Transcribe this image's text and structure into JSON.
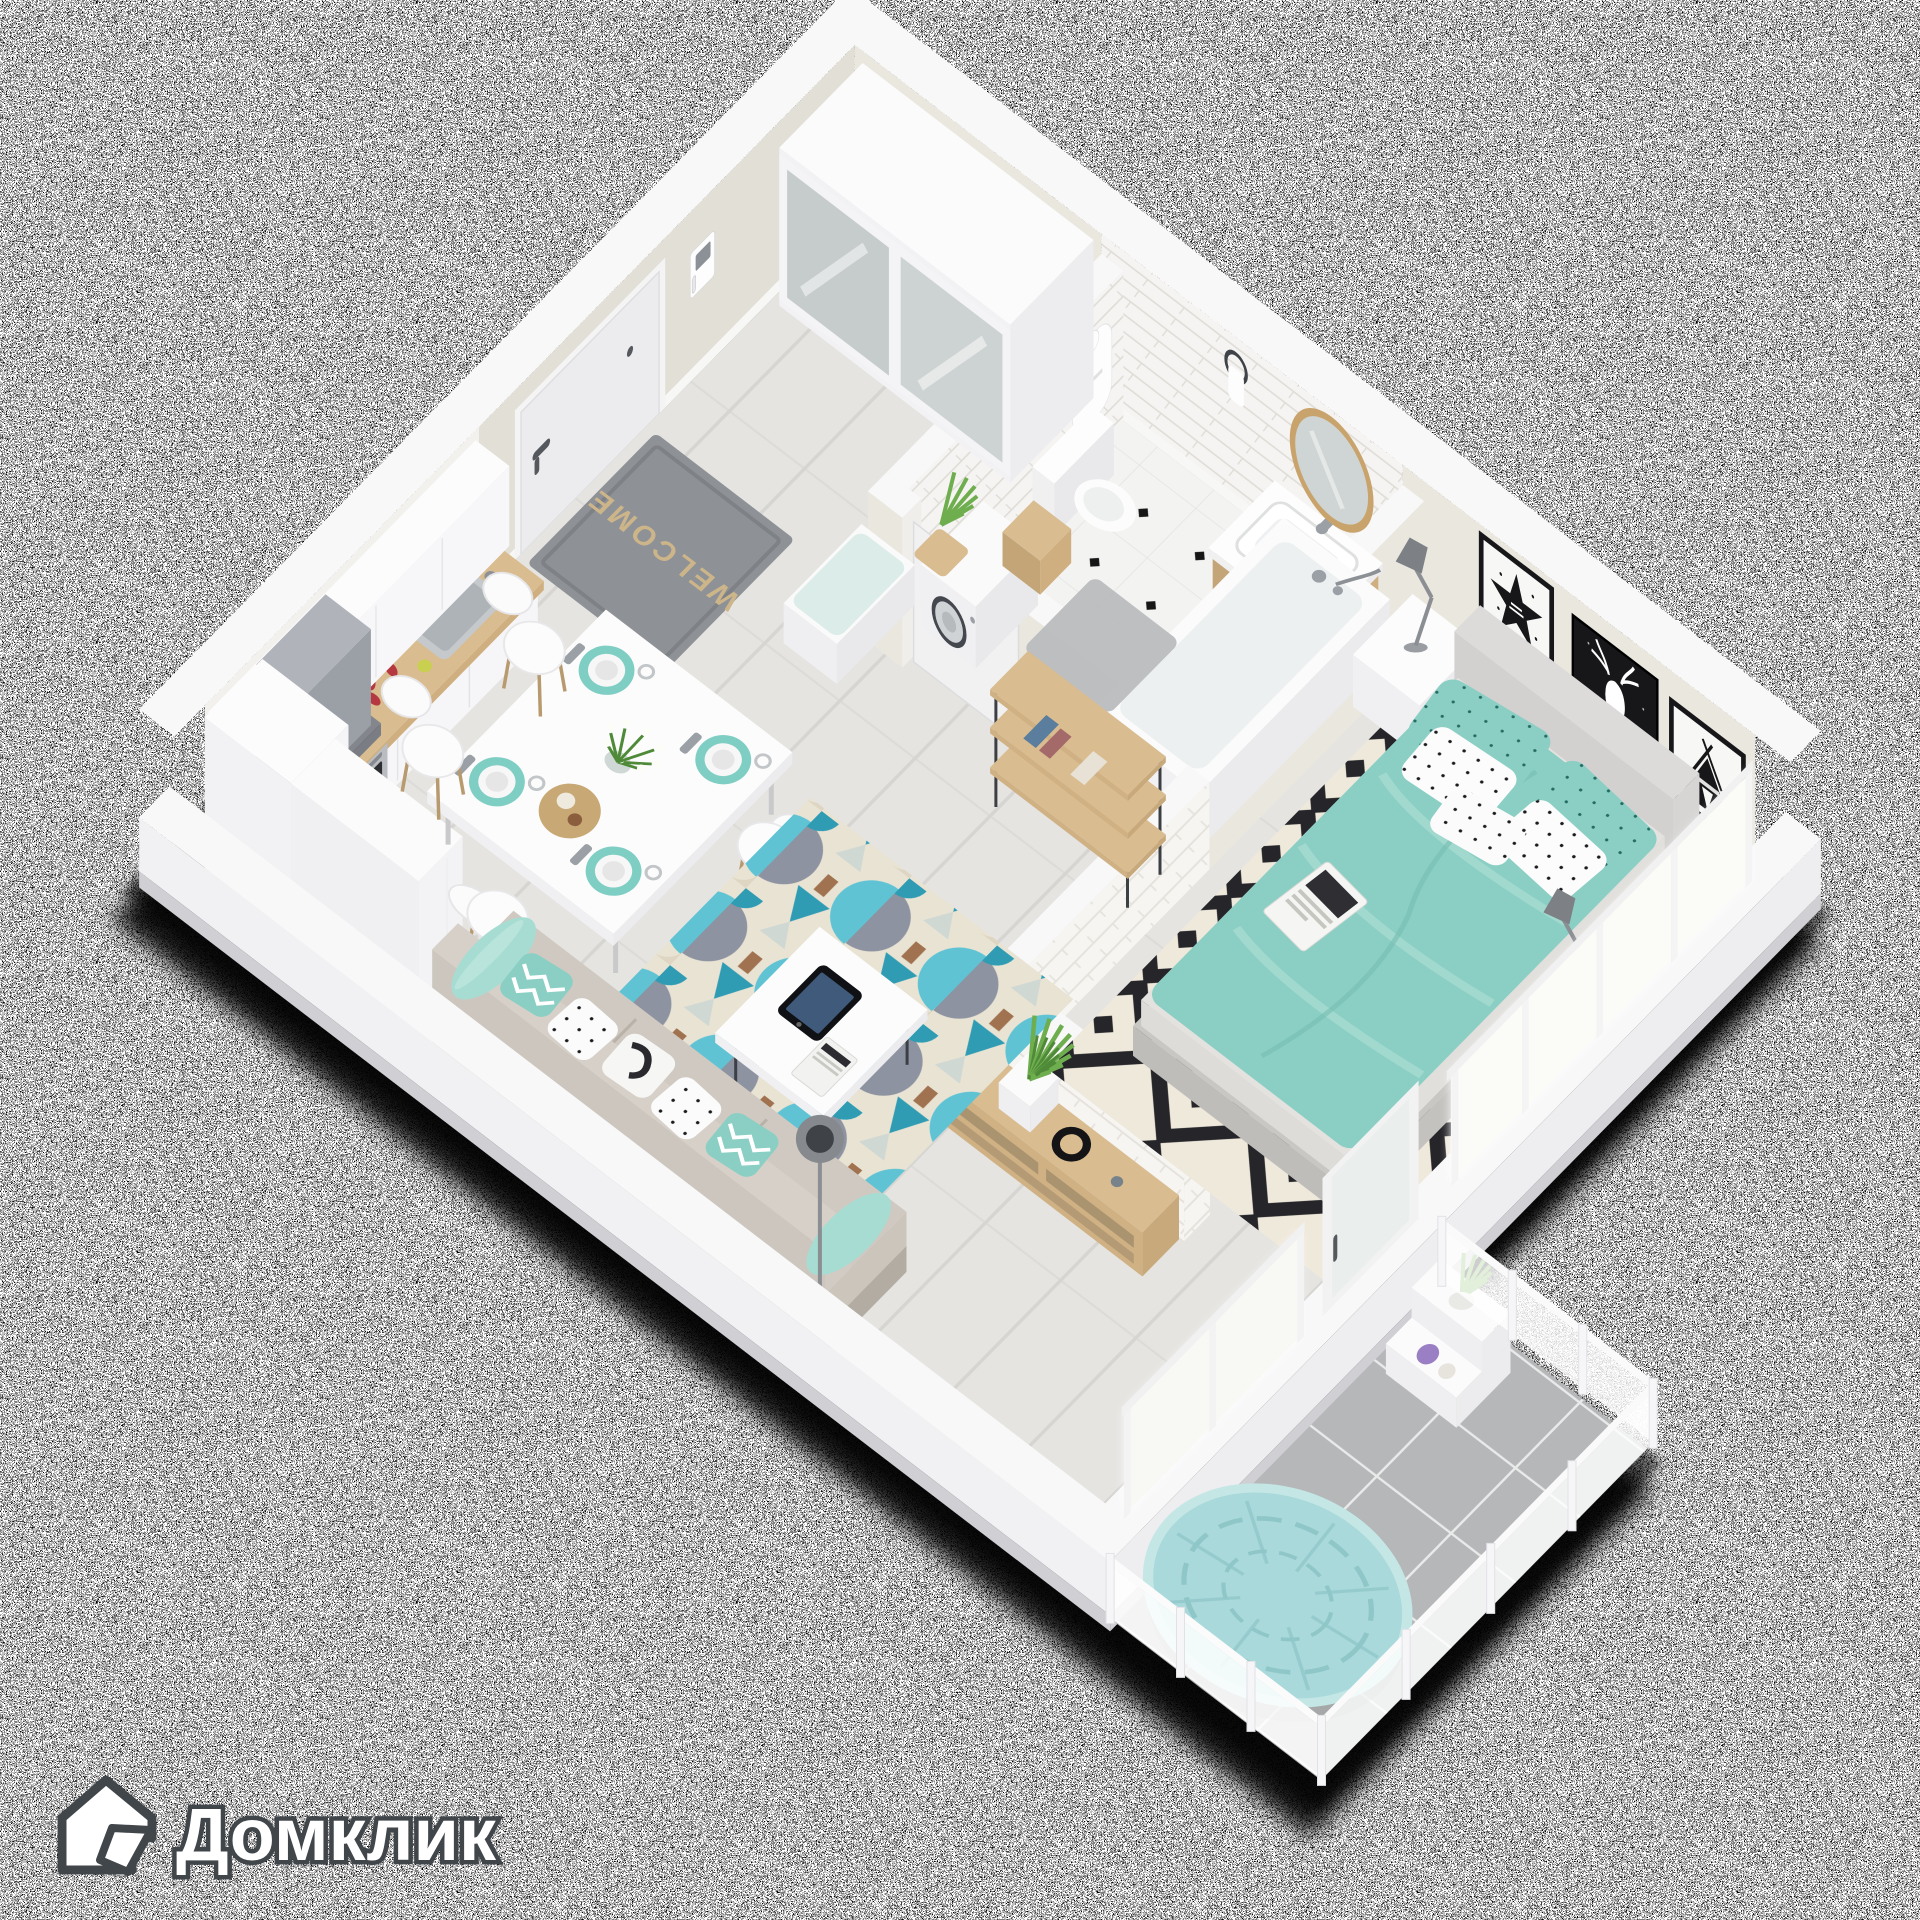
{
  "watermark": {
    "brand": "Домклик"
  },
  "entrance": {
    "mat_text": "WELCOME"
  },
  "palette": {
    "wall_top": "#f8f8f9",
    "wall_face": "#eae7df",
    "wall_face2": "#e2dfd6",
    "wall_outer": "#f0f0f2",
    "wall_outer_dark": "#cfcfd4",
    "skirting": "#f7f7f6",
    "floor_wood": "#e5e4e1",
    "floor_wood_line": "#d6d5d1",
    "bath_floor": "#f3f3f2",
    "bath_dot": "#161616",
    "bath_tile": "#f5f4f2",
    "bath_tile_line": "#dfddd7",
    "balcony_tile": "#b5b7b9",
    "balcony_grout": "#e9eaea",
    "teal": "#8bcfc4",
    "teal_light": "#a7dcd2",
    "teal_deep": "#76bdb1",
    "papasan": "#a9d9da",
    "papasan_line": "#8fc6c8",
    "rug_cream": "#e9e3d4",
    "rug_teal": "#5fc3d4",
    "rug_teal_deep": "#2f9cb4",
    "rug_gray": "#8d93a0",
    "rug_brown": "#a0724f",
    "bw_bg": "#efe9dc",
    "bw_ink": "#26262a",
    "wood": "#d9bc90",
    "wood_dark": "#c3a578",
    "white_furn": "#fbfbfb",
    "white_side": "#ededee",
    "white_side2": "#e3e3e6",
    "sofa": "#cfc9c1",
    "sofa_dark": "#b8b2a9",
    "sofa_back": "#d6d0c8",
    "frame_black": "#17171a",
    "art_white": "#f7f7f5",
    "steel": "#b9bcc0",
    "steel_dark": "#44484e",
    "hood_a": "#b0b4ba",
    "hood_b": "#8f949b",
    "hood_c": "#9ba0a7",
    "cooktop": "#17181c",
    "door": "#ececee",
    "door_frame": "#f4f4f5",
    "handle": "#55595d",
    "mat": "#8e9196",
    "mat_text": "#cdb58a",
    "glass": "#cfd5d4",
    "glass_frame": "#f2f2f3",
    "window_glow": "#ffffff",
    "green": "#6fae4e",
    "green_dark": "#4e8a38",
    "red": "#b5373f",
    "purple": "#9b7fc4",
    "brick": "#f6f5f2",
    "brick_line": "#e6e3dd",
    "logo_fill": "#ffffff",
    "logo_outline": "#41464b",
    "shadow": "#000000"
  },
  "scene": {
    "type": "isometric-floorplan-render",
    "background": "tv-static-noise",
    "rooms": [
      {
        "name": "hallway",
        "items": [
          "front-door",
          "intercom",
          "welcome-mat",
          "mirror-wardrobe",
          "bench",
          "plant"
        ]
      },
      {
        "name": "bathroom",
        "items": [
          "toilet",
          "vanity-sink",
          "round-mirror",
          "bathtub",
          "washing-machine",
          "bath-mat",
          "bathrobe"
        ]
      },
      {
        "name": "kitchen",
        "items": [
          "upper-cabinets",
          "range-hood",
          "cooktop",
          "oven",
          "counter",
          "sink",
          "tall-cabinets"
        ]
      },
      {
        "name": "dining-area",
        "items": [
          "table",
          "chairs",
          "place-settings",
          "flower-vase"
        ]
      },
      {
        "name": "living-room",
        "items": [
          "sofa",
          "geometric-rug",
          "coffee-table",
          "tablet",
          "media-console",
          "shelving-unit",
          "floor-lamp",
          "brick-half-wall"
        ]
      },
      {
        "name": "bedroom",
        "items": [
          "double-bed",
          "nightstands",
          "table-lamps",
          "diamond-rug",
          "wall-art-star",
          "wall-art-deer",
          "wall-art-teepee",
          "plant",
          "windows"
        ]
      },
      {
        "name": "balcony",
        "items": [
          "papasan-chair",
          "plant-stand",
          "glass-railing",
          "tile-floor"
        ]
      }
    ]
  }
}
